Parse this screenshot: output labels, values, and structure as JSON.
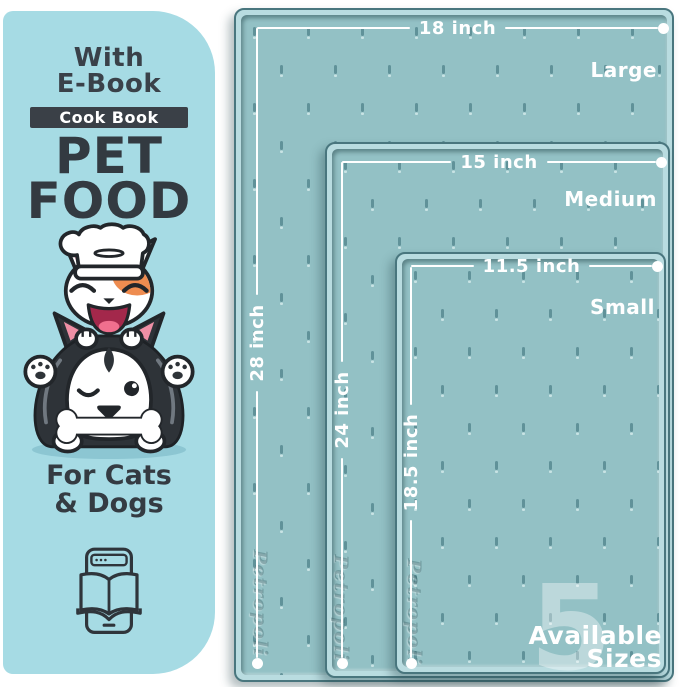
{
  "panel": {
    "with_line1": "With",
    "with_line2": "E-Book",
    "badge": "Cook Book",
    "title_line1": "PET",
    "title_line2": "FOOD",
    "for_line1": "For Cats",
    "for_line2": "& Dogs"
  },
  "mats": [
    {
      "name": "Large",
      "width": "18 inch",
      "height": "28 inch"
    },
    {
      "name": "Medium",
      "width": "15 inch",
      "height": "24 inch"
    },
    {
      "name": "Small",
      "width": "11.5 inch",
      "height": "18.5 inch"
    }
  ],
  "brand_emboss": "Petropoli",
  "available_sizes": {
    "count": "5",
    "line1": "Available",
    "line2": "Sizes"
  },
  "icons": [
    "chef-cat-dog-illustration",
    "ebook-tablet-icon",
    "mat-texture-pattern"
  ],
  "colors": {
    "panel_bg": "#a6dbe4",
    "mat_surface": "#93c1c5",
    "mat_rim": "#b9dce0",
    "rim_outline": "#49767e",
    "text_dark": "#343b42",
    "badge_bg": "#3a4047",
    "measure_white": "#ffffff",
    "cat_patch_orange": "#ee8c50",
    "ear_pink": "#ef8fa5"
  }
}
